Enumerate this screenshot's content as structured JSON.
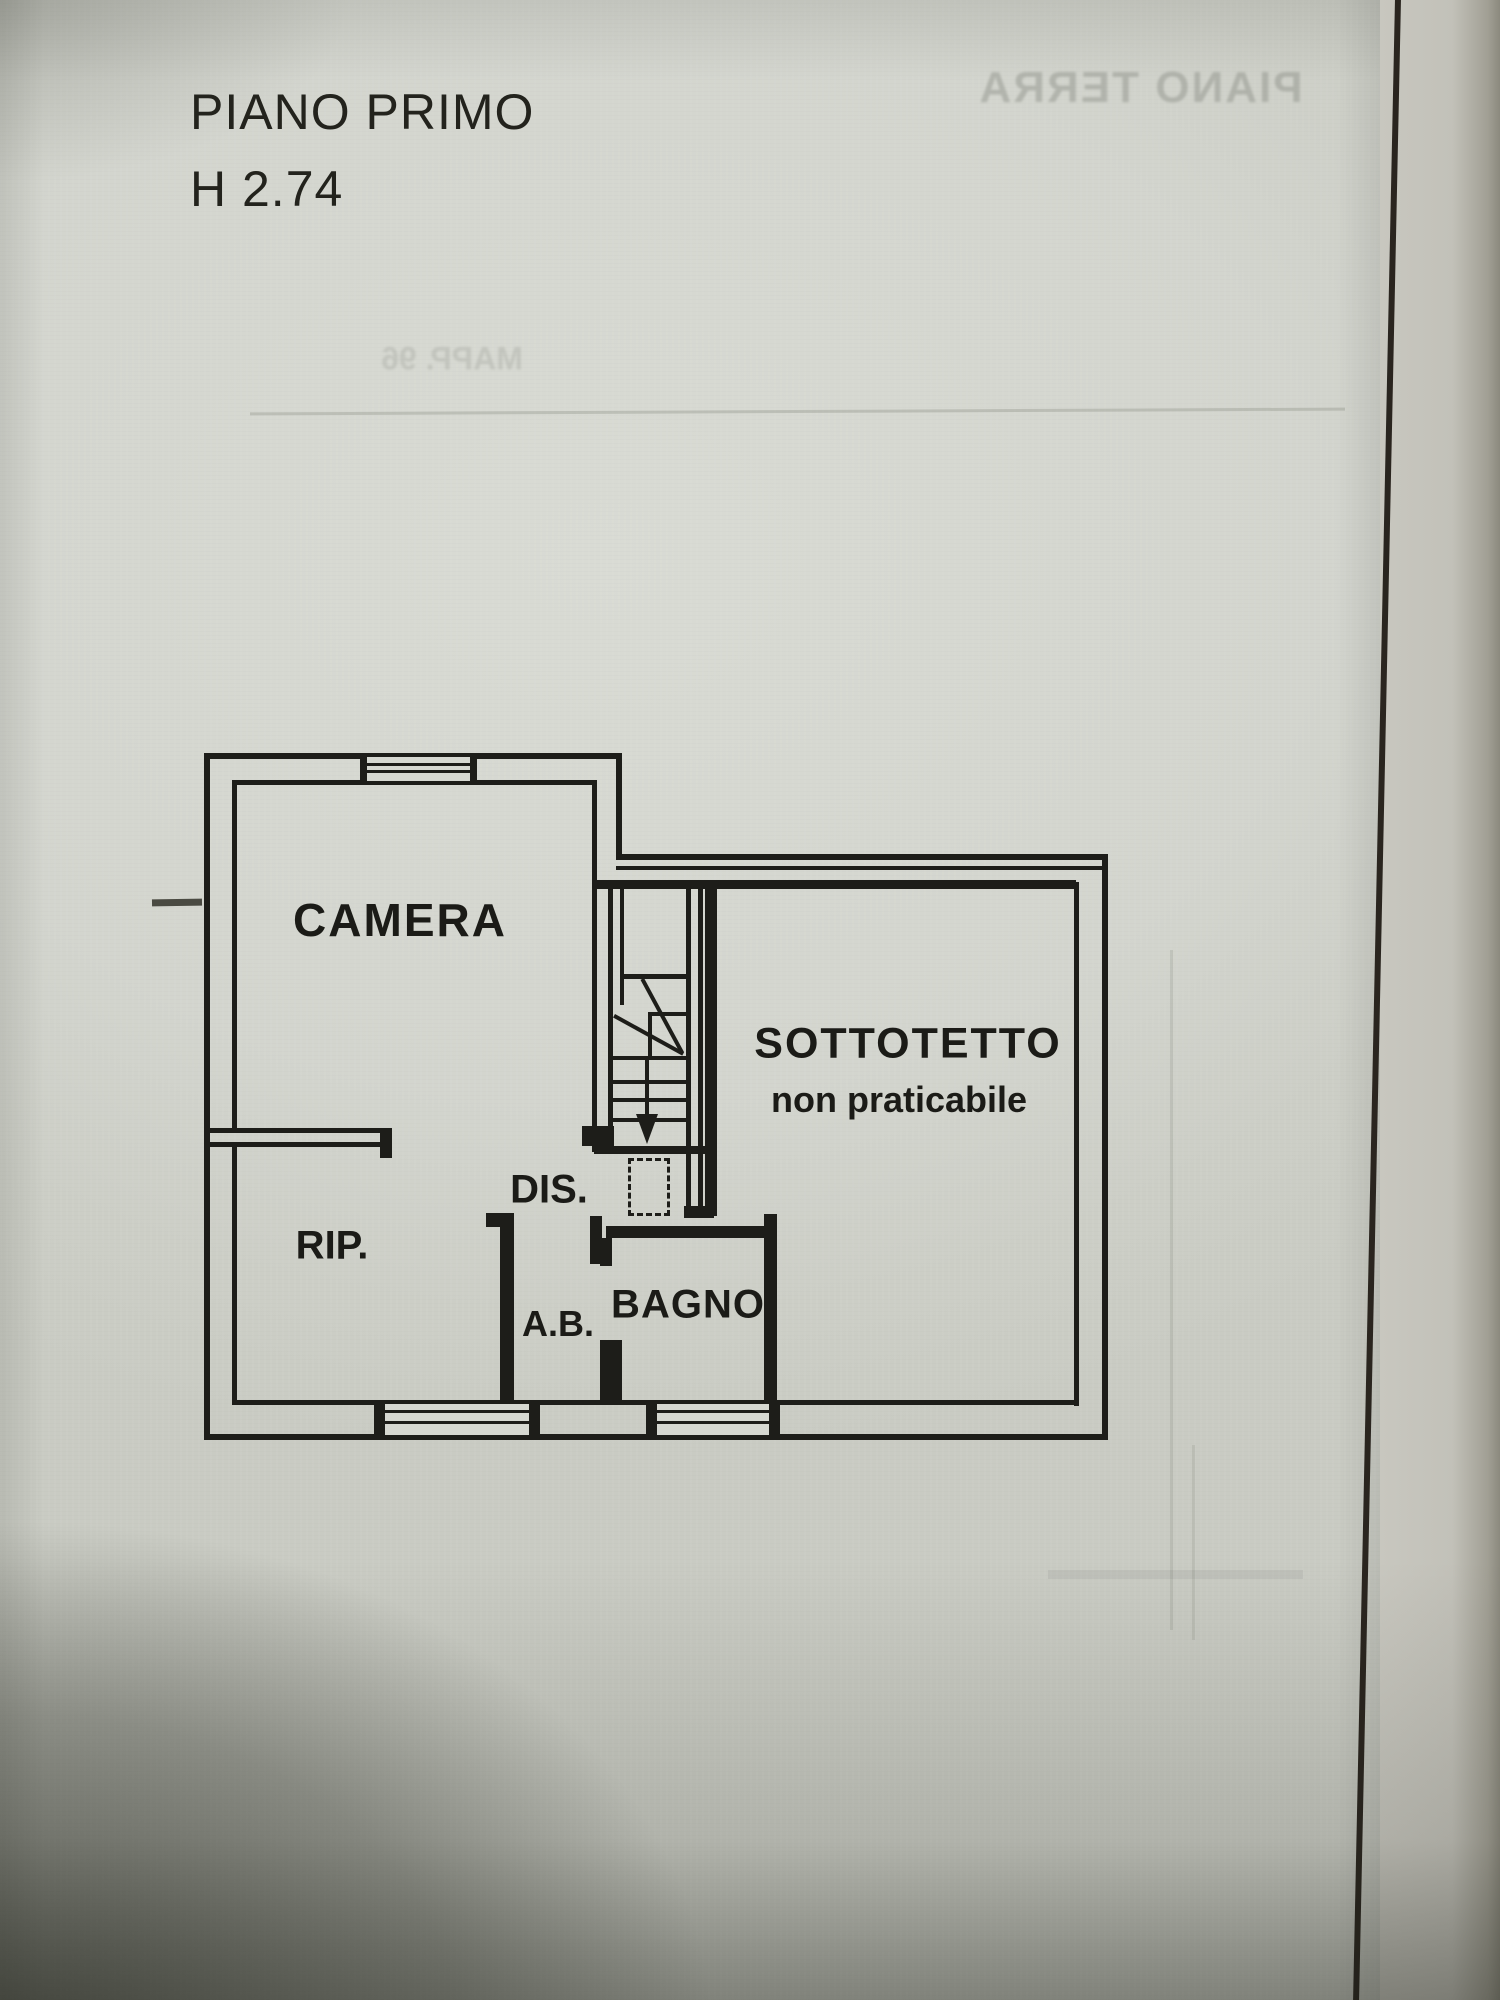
{
  "document": {
    "kind": "scanned floor plan photo",
    "title": "PIANO PRIMO",
    "height_note": "H 2.74"
  },
  "floorplan": {
    "rooms": [
      {
        "id": "camera",
        "label": "CAMERA"
      },
      {
        "id": "sottotetto",
        "label": "SOTTOTETTO",
        "sublabel": "non praticabile"
      },
      {
        "id": "dis",
        "label": "DIS."
      },
      {
        "id": "rip",
        "label": "RIP."
      },
      {
        "id": "ab",
        "label": "A.B."
      },
      {
        "id": "bagno",
        "label": "BAGNO"
      }
    ],
    "features": {
      "stair_direction": "down",
      "windows": 3,
      "dashed_duct": true
    }
  },
  "ghost_bleedthrough": {
    "top_right_mirrored": "PIANO TERRA",
    "mid_left_mirrored": "MAPP. 96"
  },
  "colors": {
    "paper": "#d3d5ce",
    "ink": "#1d1d19",
    "fold_line": "#2a251f",
    "shadow": "#1c1e16",
    "ghost_ink": "#7d8078"
  }
}
